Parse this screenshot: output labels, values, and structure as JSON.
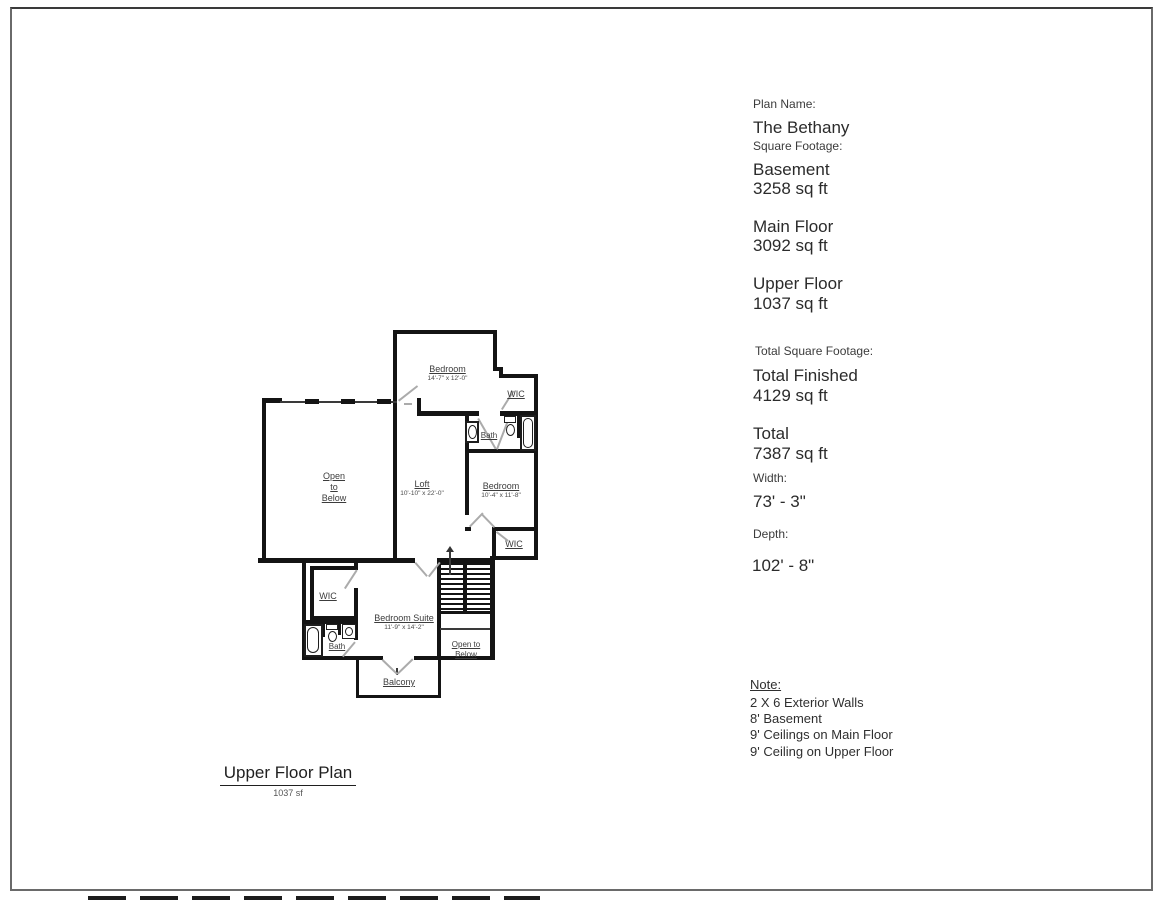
{
  "colors": {
    "wall": "#141414",
    "door_line": "#ababab",
    "text": "#3c3c3c",
    "page_border": "#6a6a6a"
  },
  "title_block": {
    "title": "Upper Floor Plan",
    "subtitle": "1037 sf"
  },
  "info_panel": {
    "plan_name_label": "Plan Name:",
    "plan_name": "The Bethany",
    "square_footage_label": "Square Footage:",
    "floors": [
      {
        "name": "Basement",
        "area": "3258 sq ft"
      },
      {
        "name": "Main Floor",
        "area": "3092 sq ft"
      },
      {
        "name": "Upper Floor",
        "area": "1037 sq ft"
      }
    ],
    "total_square_footage_label": "Total Square Footage:",
    "totals": [
      {
        "name": "Total Finished",
        "area": "4129 sq ft"
      },
      {
        "name": "Total",
        "area": "7387 sq ft"
      }
    ],
    "width_label": "Width:",
    "width_value": "73' - 3\"",
    "depth_label": "Depth:",
    "depth_value": "102' - 8\"",
    "note_title": "Note:",
    "notes": [
      "2 X 6 Exterior Walls",
      "8' Basement",
      "9' Ceilings on Main Floor",
      "9' Ceiling on Upper Floor"
    ]
  },
  "floor_plan": {
    "rooms": {
      "bedroom_top": {
        "name": "Bedroom",
        "dims": "14'-7\" x 12'-0\""
      },
      "wic_top": {
        "name": "WIC"
      },
      "bath_top": {
        "name": "Bath"
      },
      "open_to_below": {
        "line1": "Open",
        "line2": "to",
        "line3": "Below"
      },
      "loft": {
        "name": "Loft",
        "dims": "10'-10\" x 22'-0\""
      },
      "bedroom_right": {
        "name": "Bedroom",
        "dims": "10'-4\" x 11'-8\""
      },
      "wic_right": {
        "name": "WIC"
      },
      "wic_left": {
        "name": "WIC"
      },
      "bath_left": {
        "name": "Bath"
      },
      "bedroom_suite": {
        "name": "Bedroom Suite",
        "dims": "11'-9\" x 14'-2\""
      },
      "balcony": {
        "name": "Balcony"
      },
      "stair_well": {
        "line1": "Open to",
        "line2": "Below"
      }
    }
  }
}
